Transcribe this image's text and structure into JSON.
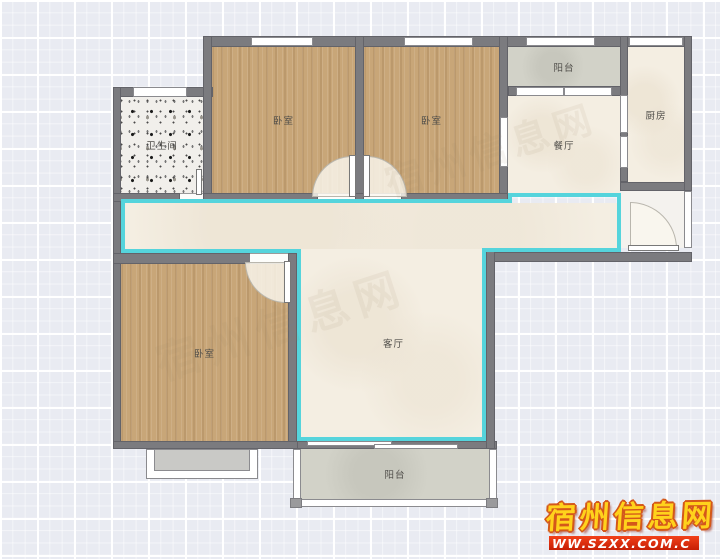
{
  "plan": {
    "type": "apartment-floor-plan",
    "rooms": [
      {
        "key": "bathroom",
        "label": "卫生间"
      },
      {
        "key": "bedroom-top-left",
        "label": "卧室"
      },
      {
        "key": "bedroom-top-right",
        "label": "卧室"
      },
      {
        "key": "balcony-top",
        "label": "阳台"
      },
      {
        "key": "dining-room",
        "label": "餐厅"
      },
      {
        "key": "kitchen",
        "label": "厨房"
      },
      {
        "key": "bedroom-bottom-left",
        "label": "卧室"
      },
      {
        "key": "living-room",
        "label": "客厅"
      },
      {
        "key": "balcony-bottom",
        "label": "阳台"
      }
    ]
  },
  "watermark": {
    "site_name": "宿州信息网",
    "site_url": "WW.SZXX.COM.C"
  },
  "colors": {
    "background": "#e9ebf2",
    "wall_gray": "#7b7b7f",
    "floor_wood": "#c8a678",
    "floor_cream": "#f4eee2",
    "floor_balcony_gray": "#d2d2c8",
    "floor_terrazzo_base": "#f1efeb",
    "zone_accent_cyan": "#55d4dc",
    "watermark_yellow": "#ffd21c",
    "watermark_banner_red": "#d92b0d"
  }
}
